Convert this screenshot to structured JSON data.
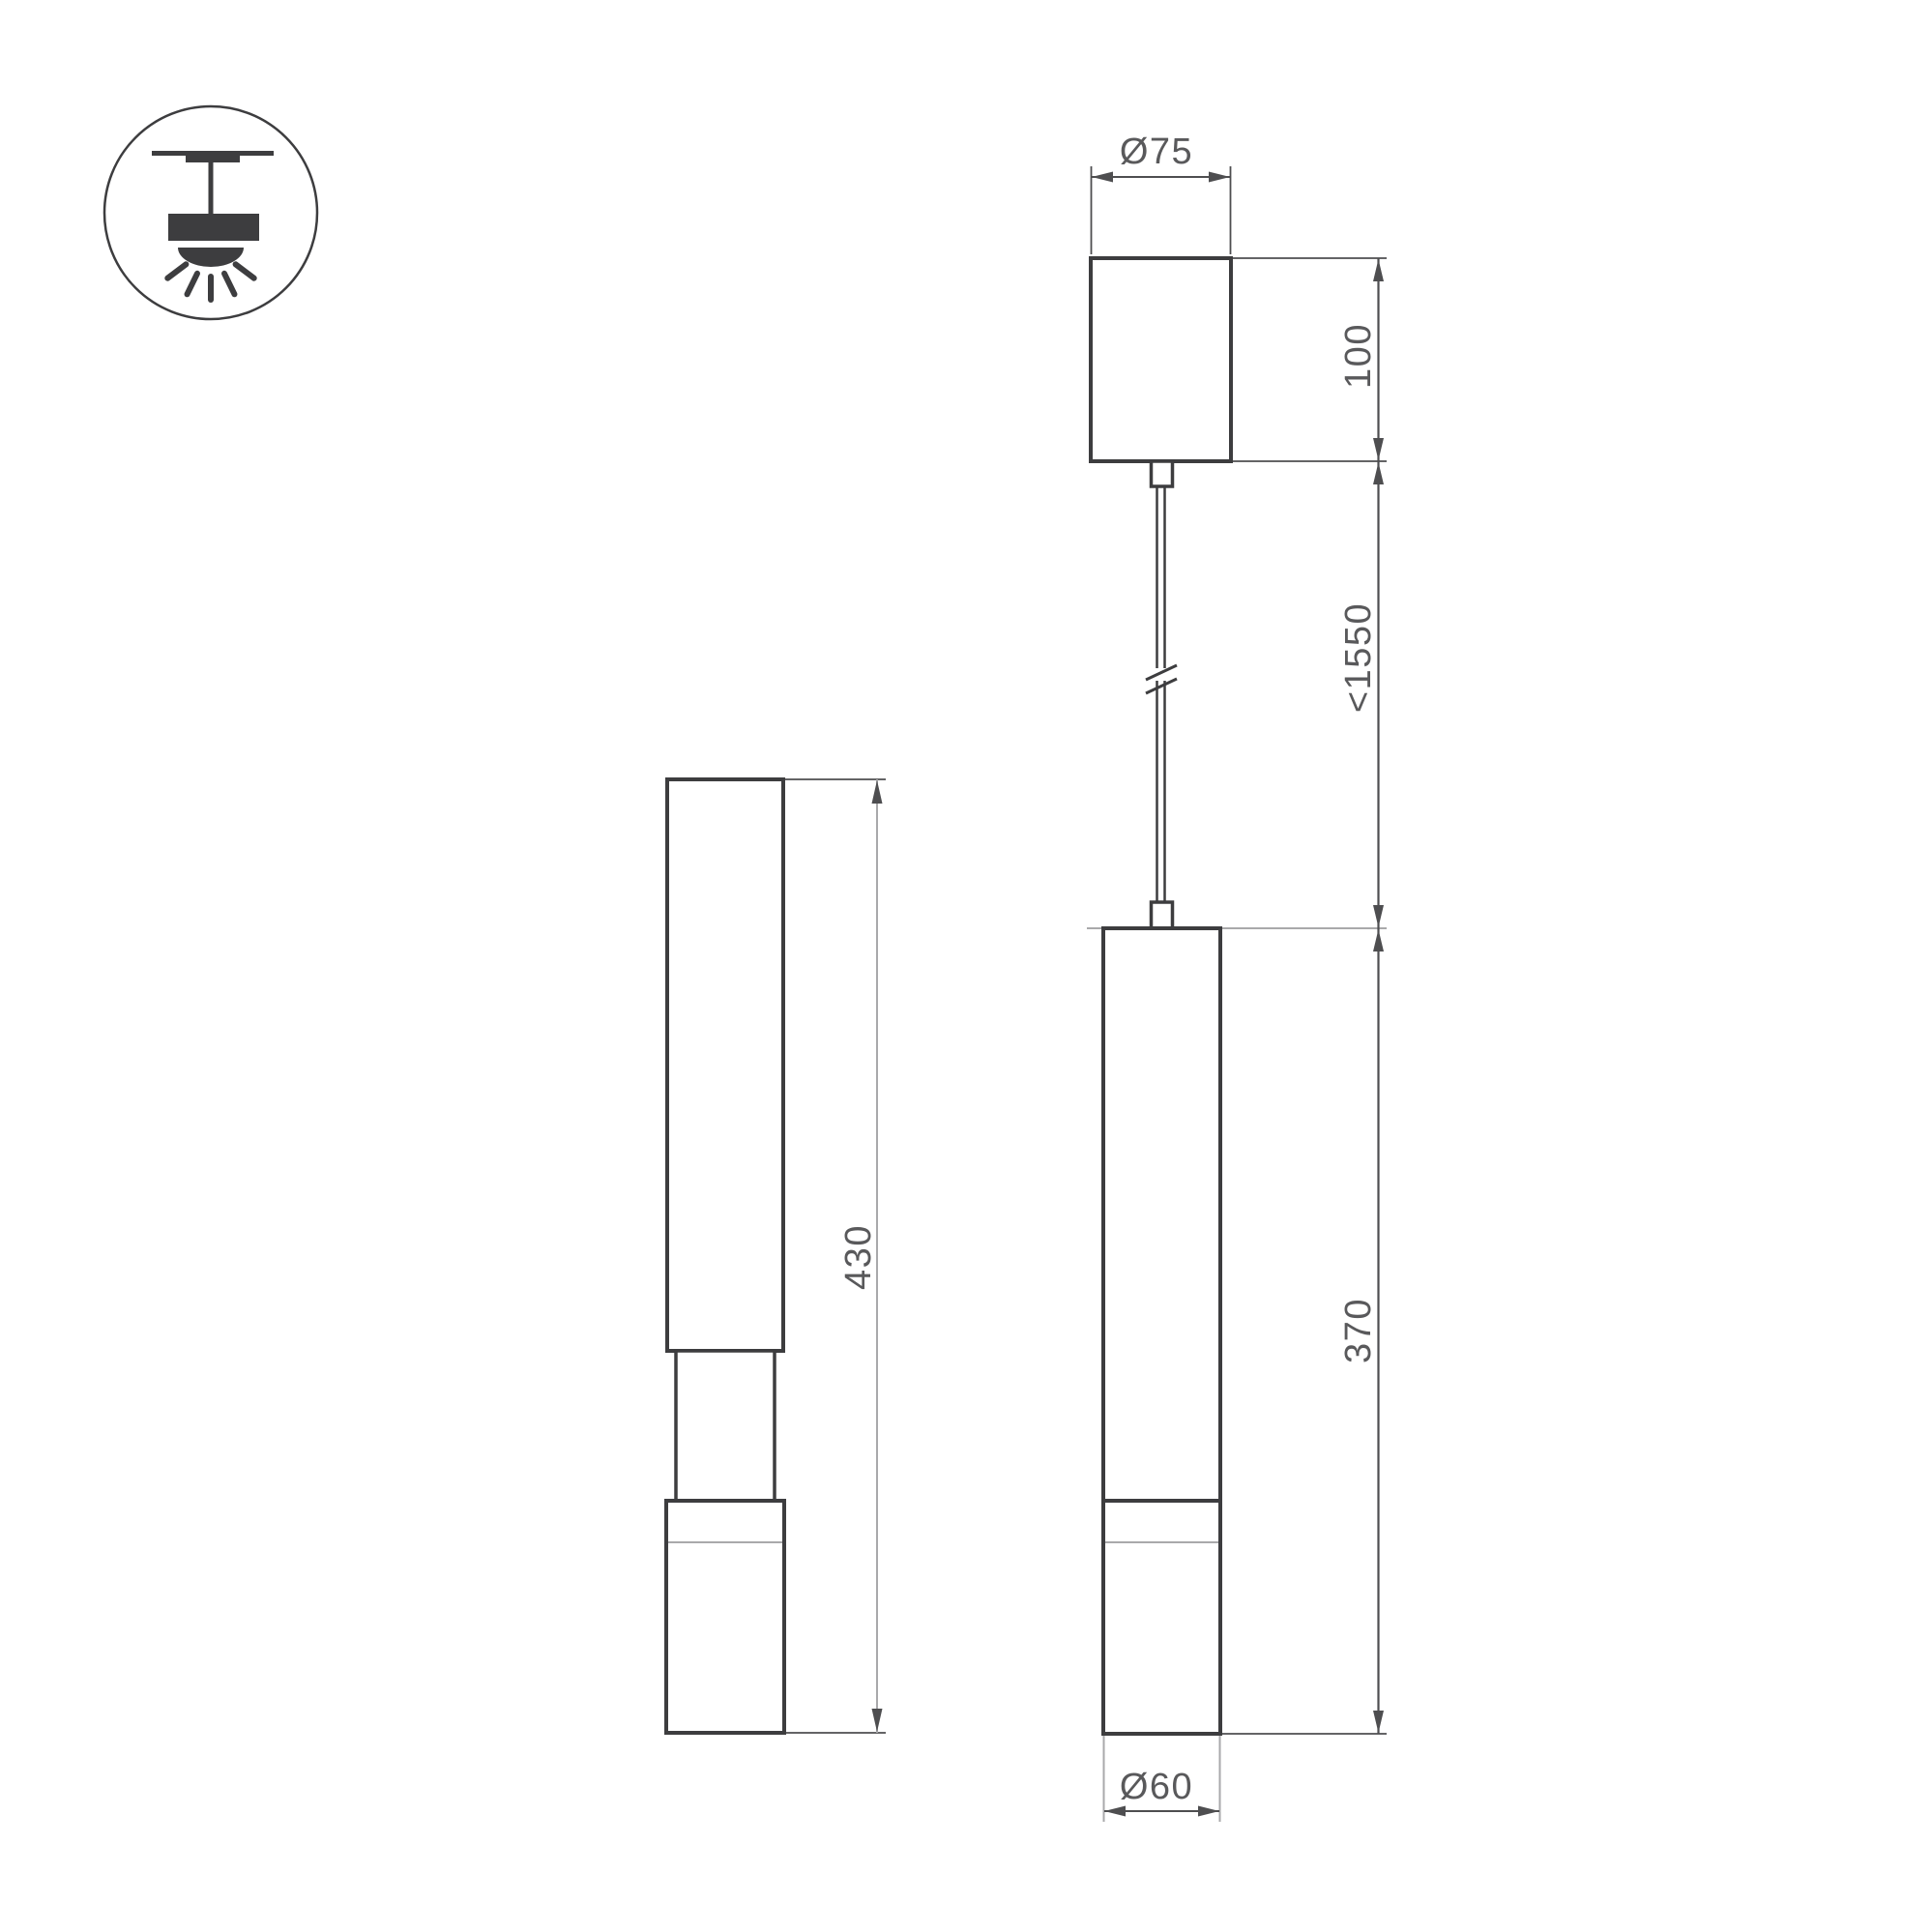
{
  "meta": {
    "title": "Pendant luminaire dimension drawing"
  },
  "colors": {
    "background": "#ffffff",
    "outline": "#3d3d3f",
    "dimension": "#4e4e50",
    "light-gray": "#a9a9ab",
    "text": "#59595b"
  },
  "icon": {
    "name": "pendant-ceiling-mount-icon"
  },
  "dimensions": {
    "canopy_diameter": "Ø75",
    "canopy_height": "100",
    "suspension_length": "<1550",
    "body_height": "370",
    "body_diameter": "Ø60",
    "side_overall_height": "430"
  }
}
